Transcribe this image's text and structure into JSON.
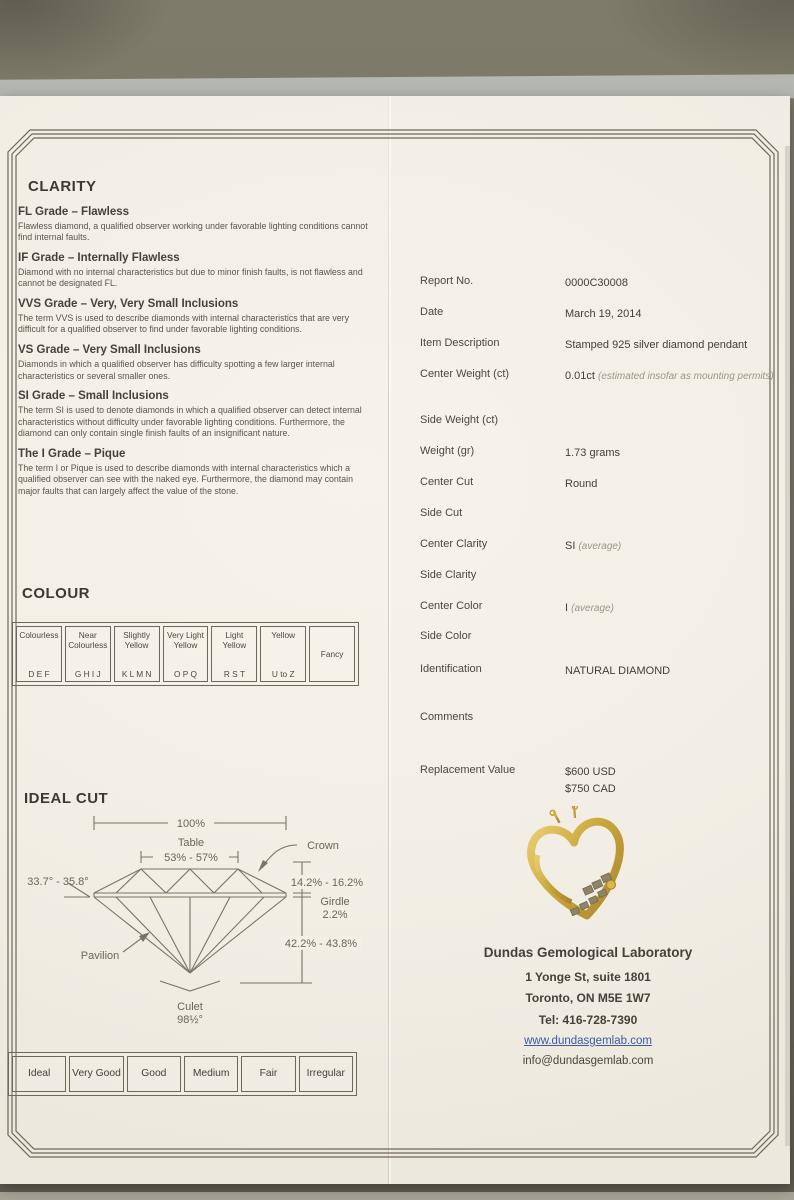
{
  "colors": {
    "backdrop": "#79756 4",
    "paper": "#f3efe6",
    "frame_line": "#6f665a",
    "link_blue": "#3a5ba0",
    "gold": "#c8a43c"
  },
  "clarity": {
    "title": "CLARITY",
    "grades": [
      {
        "name": "FL Grade – Flawless",
        "desc": "Flawless diamond, a qualified observer working under favorable lighting conditions cannot find internal faults."
      },
      {
        "name": "IF Grade – Internally Flawless",
        "desc": "Diamond with no internal characteristics but due to minor finish faults, is not flawless and cannot be designated FL."
      },
      {
        "name": "VVS Grade – Very, Very Small Inclusions",
        "desc": "The term VVS is used to describe diamonds with internal characteristics that are very difficult for a qualified observer to find under favorable lighting conditions."
      },
      {
        "name": "VS Grade – Very Small Inclusions",
        "desc": "Diamonds in which a qualified observer has difficulty spotting a few larger internal characteristics or several smaller ones."
      },
      {
        "name": "SI Grade – Small Inclusions",
        "desc": "The term SI is used to denote diamonds in which a qualified observer can detect internal characteristics without difficulty under favorable lighting conditions. Furthermore, the diamond can only contain single finish faults of an insignificant nature."
      },
      {
        "name": "The I Grade – Pique",
        "desc": "The term I or Pique is used to describe diamonds with internal characteristics which a qualified observer can see with the naked eye. Furthermore, the diamond may contain major faults that can largely affect the value of the stone."
      }
    ]
  },
  "colour": {
    "title": "COLOUR",
    "cells": [
      {
        "label": "Colourless",
        "letters": "D E F"
      },
      {
        "label": "Near Colourless",
        "letters": "G H I J"
      },
      {
        "label": "Slightly Yellow",
        "letters": "K L M N"
      },
      {
        "label": "Very Light Yellow",
        "letters": "O P Q"
      },
      {
        "label": "Light Yellow",
        "letters": "R S T"
      },
      {
        "label": "Yellow",
        "letters": "U to Z"
      },
      {
        "label": "Fancy",
        "letters": ""
      }
    ]
  },
  "ideal_cut": {
    "title": "IDEAL CUT",
    "labels": {
      "total": "100%",
      "table": "Table",
      "table_range": "53% - 57%",
      "crown": "Crown",
      "crown_angle": "33.7° - 35.8°",
      "crown_height": "14.2% - 16.2%",
      "girdle": "Girdle",
      "girdle_pct": "2.2%",
      "pavilion_depth": "42.2% - 43.8%",
      "pavilion": "Pavilion",
      "culet": "Culet",
      "culet_angle": "98½°"
    }
  },
  "cut_grades": [
    "Ideal",
    "Very Good",
    "Good",
    "Medium",
    "Fair",
    "Irregular"
  ],
  "report": {
    "rows": [
      {
        "label": "Report No.",
        "value": "0000C30008",
        "note": ""
      },
      {
        "label": "Date",
        "value": "March 19, 2014",
        "note": ""
      },
      {
        "label": "Item Description",
        "value": "Stamped 925 silver diamond pendant",
        "note": ""
      },
      {
        "label": "Center Weight (ct)",
        "value": "0.01ct",
        "note": "(estimated insofar as mounting permits)"
      },
      {
        "label": "Side Weight (ct)",
        "value": "",
        "note": ""
      },
      {
        "label": "Weight (gr)",
        "value": "1.73 grams",
        "note": ""
      },
      {
        "label": "Center Cut",
        "value": "Round",
        "note": ""
      },
      {
        "label": "Side Cut",
        "value": "",
        "note": ""
      },
      {
        "label": "Center Clarity",
        "value": "SI",
        "note": "(average)"
      },
      {
        "label": "Side Clarity",
        "value": "",
        "note": ""
      },
      {
        "label": "Center Color",
        "value": "I",
        "note": "(average)"
      },
      {
        "label": "Side Color",
        "value": "",
        "note": ""
      },
      {
        "label": "Identification",
        "value": "NATURAL DIAMOND",
        "note": ""
      },
      {
        "label": "Comments",
        "value": "",
        "note": ""
      },
      {
        "label": "Replacement Value",
        "value": "$600 USD",
        "value2": "$750 CAD",
        "note": ""
      }
    ]
  },
  "lab": {
    "name": "Dundas Gemological Laboratory",
    "address1": "1 Yonge St, suite 1801",
    "address2": "Toronto, ON M5E 1W7",
    "phone": "Tel: 416-728-7390",
    "website": "www.dundasgemlab.com",
    "email": "info@dundasgemlab.com"
  }
}
